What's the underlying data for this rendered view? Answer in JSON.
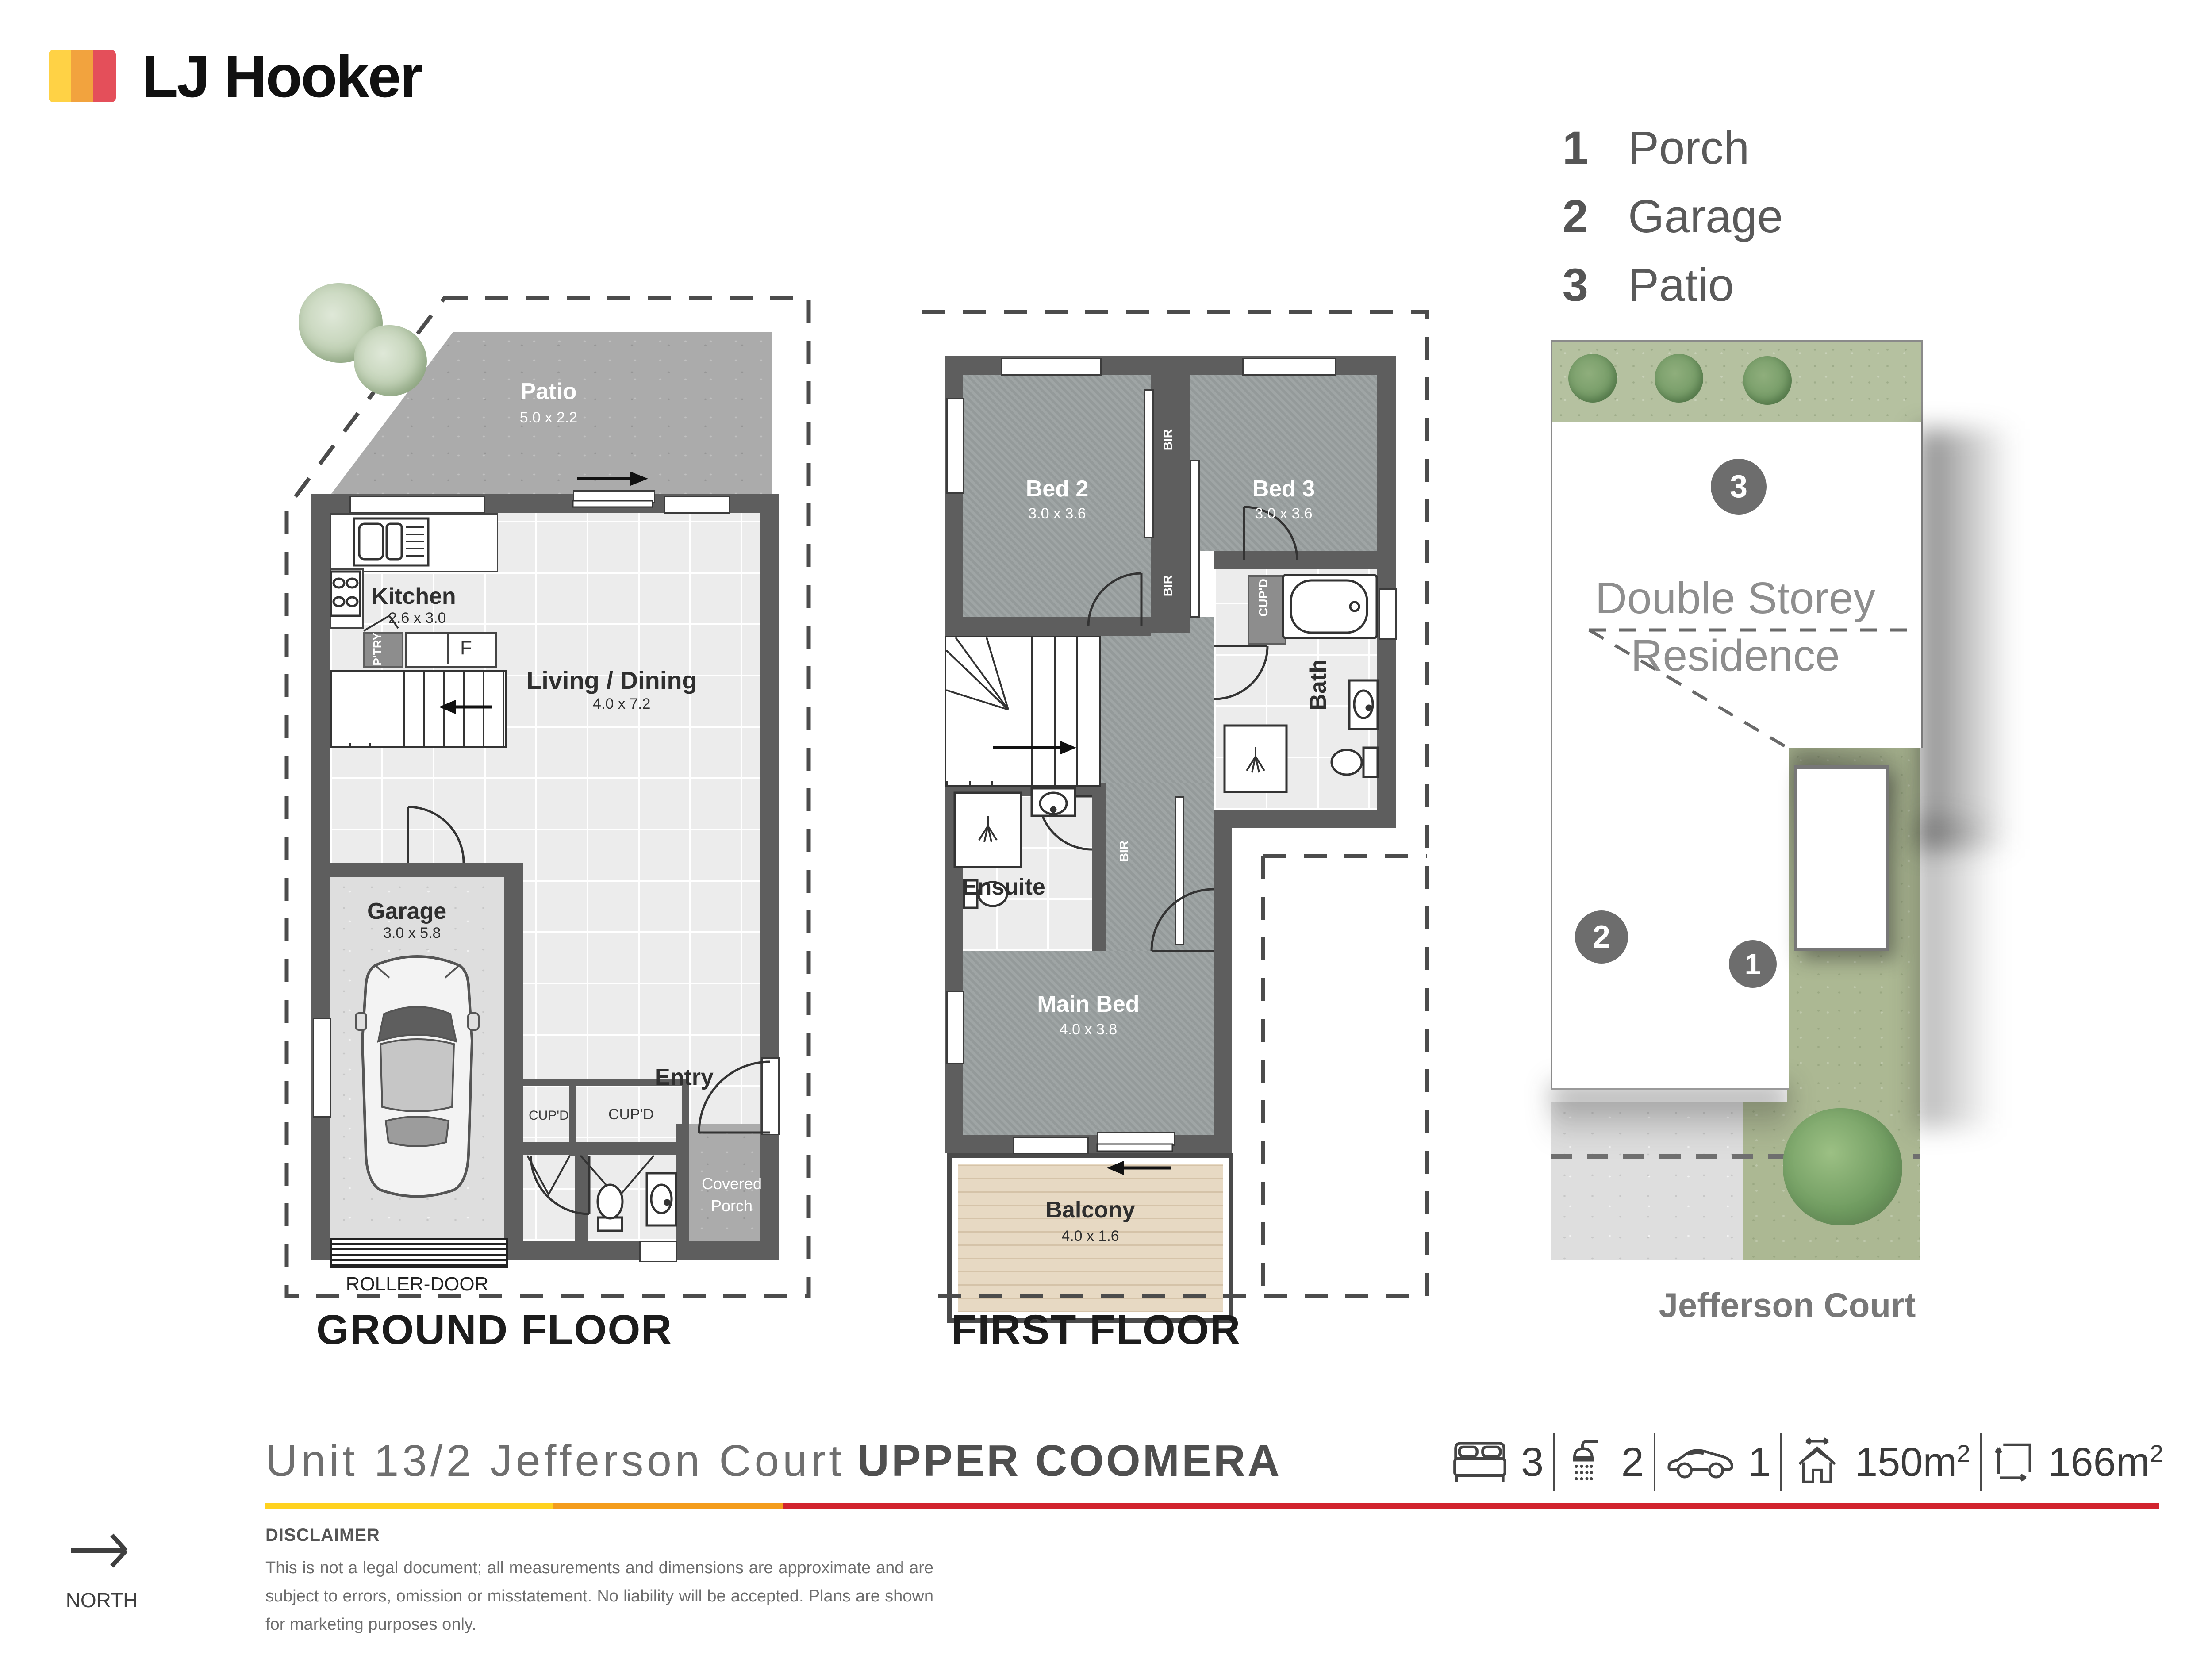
{
  "logo": {
    "brand": "LJ Hooker",
    "colors": {
      "yellow": "#ffd245",
      "orange": "#f2a33e",
      "red": "#e44f5a"
    }
  },
  "legend": {
    "items": [
      {
        "num": "1",
        "label": "Porch"
      },
      {
        "num": "2",
        "label": "Garage"
      },
      {
        "num": "3",
        "label": "Patio"
      }
    ]
  },
  "ground_floor": {
    "title": "GROUND FLOOR",
    "patio": {
      "name": "Patio",
      "dims": "5.0 x 2.2"
    },
    "kitchen": {
      "name": "Kitchen",
      "dims": "2.6 x 3.0"
    },
    "living": {
      "name": "Living / Dining",
      "dims": "4.0 x 7.2"
    },
    "garage": {
      "name": "Garage",
      "dims": "3.0 x 5.8"
    },
    "entry": {
      "name": "Entry"
    },
    "covered_porch": {
      "line1": "Covered",
      "line2": "Porch"
    },
    "pantry": "P'TRY",
    "fridge": "F",
    "cupd1": "CUP'D",
    "cupd2": "CUP'D",
    "roller": "ROLLER-DOOR"
  },
  "first_floor": {
    "title": "FIRST FLOOR",
    "bed2": {
      "name": "Bed 2",
      "dims": "3.0 x 3.6"
    },
    "bed3": {
      "name": "Bed 3",
      "dims": "3.0 x 3.6"
    },
    "main_bed": {
      "name": "Main Bed",
      "dims": "4.0 x 3.8"
    },
    "ensuite": {
      "name": "Ensuite"
    },
    "bath": {
      "name": "Bath"
    },
    "balcony": {
      "name": "Balcony",
      "dims": "4.0 x 1.6"
    },
    "bir1": "BIR",
    "bir2": "BIR",
    "bir3": "BIR",
    "cupd": "CUP'D"
  },
  "site_plan": {
    "badge_patio": "3",
    "badge_garage": "2",
    "badge_porch": "1",
    "residence_line1": "Double Storey",
    "residence_line2": "Residence",
    "street": "Jefferson Court"
  },
  "footer": {
    "address_light": "Unit 13/2 Jefferson Court",
    "address_bold": "UPPER COOMERA",
    "stats": [
      {
        "icon": "bed-icon",
        "value": "3"
      },
      {
        "icon": "shower-icon",
        "value": "2"
      },
      {
        "icon": "car-icon",
        "value": "1"
      },
      {
        "icon": "house-area-icon",
        "value": "150m",
        "sup": "2"
      },
      {
        "icon": "land-area-icon",
        "value": "166m",
        "sup": "2"
      }
    ],
    "rule_colors": {
      "yellow": "#ffd21f",
      "orange": "#f49d1d",
      "red": "#d2232e"
    },
    "disclaimer_title": "DISCLAIMER",
    "disclaimer_body": "This is not a legal document; all measurements and dimensions are approximate and are subject to errors, omission or misstatement. No liability will be accepted. Plans are shown for marketing purposes only.",
    "north": "NORTH"
  }
}
